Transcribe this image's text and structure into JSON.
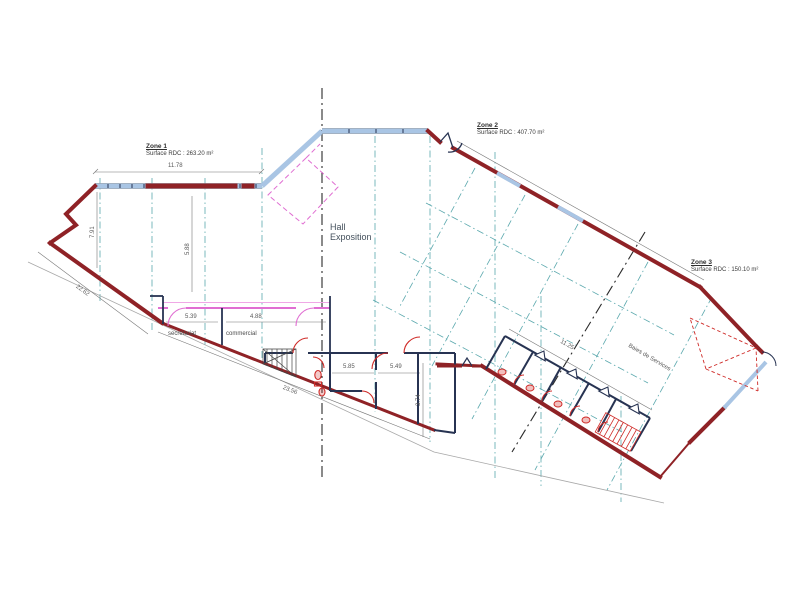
{
  "drawing": {
    "zones": [
      {
        "name": "Zone 1",
        "surface": "Surface RDC : 263.20 m²"
      },
      {
        "name": "Zone 2",
        "surface": "Surface RDC : 407.70 m²"
      },
      {
        "name": "Zone 3",
        "surface": "Surface RDC : 150.10 m²"
      }
    ],
    "rooms": {
      "hall_line1": "Hall",
      "hall_line2": "Exposition",
      "secretariat": "secrétariat",
      "commercial": "commercial",
      "baies": "Baies de Services"
    },
    "dims": [
      {
        "value": "11.78"
      },
      {
        "value": "7.91"
      },
      {
        "value": "5.88"
      },
      {
        "value": "22.62"
      },
      {
        "value": "23.56"
      },
      {
        "value": "5.39"
      },
      {
        "value": "4.88"
      },
      {
        "value": "5.85"
      },
      {
        "value": "5.49"
      },
      {
        "value": "3.74"
      },
      {
        "value": "11.25"
      }
    ],
    "colors": {
      "wall_red": "#8f2226",
      "glazing_blue": "#a9c5e4",
      "grid_teal": "#5aa8ad",
      "partition_navy": "#273352",
      "accent_pink": "#e06ed2",
      "fixture_red": "#cf2a27",
      "dim_gray": "#6a6a6a"
    }
  }
}
